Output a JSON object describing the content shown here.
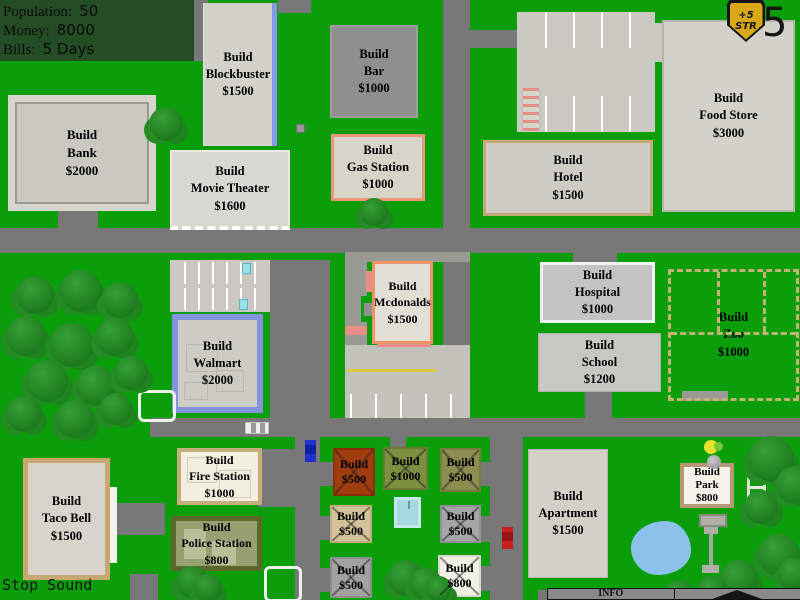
{
  "hud": {
    "rows": [
      {
        "label": "Population:",
        "value": "50"
      },
      {
        "label": "Money:",
        "value": "8000"
      },
      {
        "label": "Bills:",
        "value": "5 Days"
      }
    ]
  },
  "badge": {
    "bonus_line1": "+5",
    "bonus_line2": "STR",
    "day_counter": "5"
  },
  "buildings": {
    "bank": {
      "line1": "Build",
      "line2": "Bank",
      "line3": "$2000"
    },
    "blockbuster": {
      "line1": "Build",
      "line2": "Blockbuster",
      "line3": "$1500"
    },
    "movie_theater": {
      "line1": "Build",
      "line2": "Movie Theater",
      "line3": "$1600"
    },
    "bar": {
      "line1": "Build",
      "line2": "Bar",
      "line3": "$1000"
    },
    "gas_station": {
      "line1": "Build",
      "line2": "Gas Station",
      "line3": "$1000"
    },
    "hotel": {
      "line1": "Build",
      "line2": "Hotel",
      "line3": "$1500"
    },
    "food_store": {
      "line1": "Build",
      "line2": "Food Store",
      "line3": "$3000"
    },
    "mcdonalds": {
      "line1": "Build",
      "line2": "Mcdonalds",
      "line3": "$1500"
    },
    "hospital": {
      "line1": "Build",
      "line2": "Hospital",
      "line3": "$1000"
    },
    "school": {
      "line1": "Build",
      "line2": "School",
      "line3": "$1200"
    },
    "zoo": {
      "line1": "Build",
      "line2": "Zoo",
      "line3": "$1000"
    },
    "walmart": {
      "line1": "Build",
      "line2": "Walmart",
      "line3": "$2000"
    },
    "taco_bell": {
      "line1": "Build",
      "line2": "Taco Bell",
      "line3": "$1500"
    },
    "fire_station": {
      "line1": "Build",
      "line2": "Fire Station",
      "line3": "$1000"
    },
    "police_station": {
      "line1": "Build",
      "line2": "Police Station",
      "line3": "$800"
    },
    "apartment": {
      "line1": "Build",
      "line2": "Apartment",
      "line3": "$1500"
    },
    "park": {
      "line1": "Build",
      "line2": "Park",
      "line3": "$800"
    }
  },
  "houses": [
    {
      "line1": "Build",
      "line2": "$500"
    },
    {
      "line1": "Build",
      "line2": "$1000"
    },
    {
      "line1": "Build",
      "line2": "$500"
    },
    {
      "line1": "Build",
      "line2": "$500"
    },
    {
      "line1": "Build",
      "line2": "$500"
    },
    {
      "line1": "Build",
      "line2": "$500"
    },
    {
      "line1": "Build",
      "line2": "$800"
    }
  ],
  "bottom_bar": {
    "sound_button": "Stop Sound",
    "info_tab": "INFO"
  },
  "colors": {
    "grass": "#0a9e0a",
    "road": "#787878",
    "parking": "#c9c9c1",
    "hud_panel": "#264a26",
    "badge_gold": "#d8a818",
    "pond_blue": "#8cc2ea",
    "pool_blue": "#a6d8e0",
    "blockbuster_blue": "#8898e8",
    "walmart_blue": "#8494dc",
    "mcdonalds_orange": "#f09468",
    "gas_salmon": "#ea9678",
    "police_olive": "#5a682a",
    "house_red": "#a13c0e"
  }
}
